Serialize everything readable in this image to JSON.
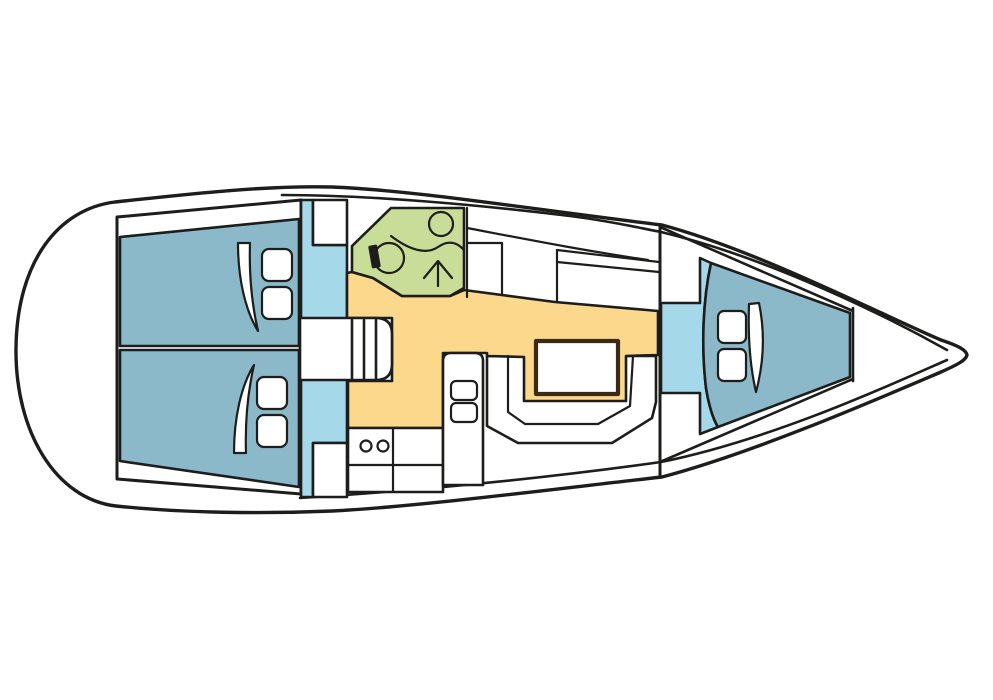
{
  "colors": {
    "page-bg": "#ffffff",
    "outline": "#1d1d1b",
    "hull-white": "#ffffff",
    "berth-blue": "#8cb9c9",
    "floor-cyan": "#a5d8e8",
    "head-green": "#c9dd98",
    "salon-orange": "#fcd88d",
    "table-brown": "#3a2b12"
  }
}
